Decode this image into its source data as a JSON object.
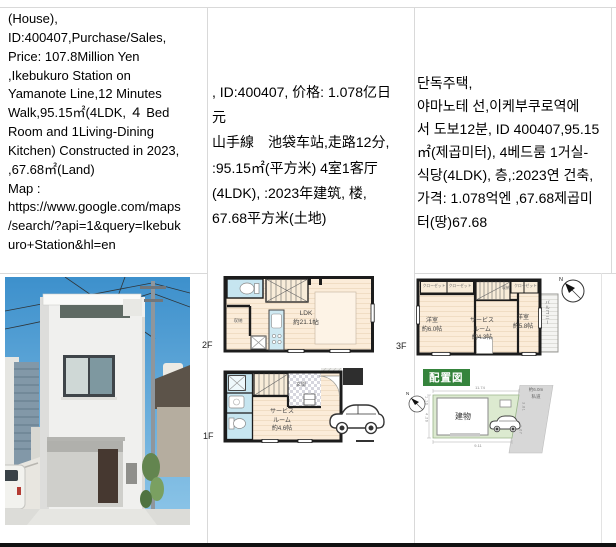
{
  "listing": {
    "en": "(House),\nID:400407,Purchase/Sales,\nPrice: 107.8Million Yen\n,Ikebukuro Station on\nYamanote Line,12 Minutes\nWalk,95.15㎡(4LDK, ４ Bed\nRoom and 1Living-Dining\nKitchen) Constructed in 2023,\n,67.68㎡(Land)\nMap :\nhttps://www.google.com/maps\n/search/?api=1&query=Ikebuk\nuro+Station&hl=en",
    "zh": ", ID:400407, 价格: 1.078亿日\n元\n山手線　池袋车站,走路12分,\n:95.15㎡(平方米) 4室1客厅\n(4LDK), :2023年建筑, 楼,\n67.68平方米(土地)",
    "ko": "단독주택,\n야마노테 선,이케부쿠로역에\n서 도보12분, ID 400407,95.15\n㎡(제곱미터), 4베드룸 1거실-\n식당(4LDK), 층,:2023연 건축,\n가격: 1.078억엔 ,67.68제곱미\n터(땅)67.68"
  },
  "plans": {
    "f2": {
      "floor_label": "2F",
      "ldk": "LDK\n約21.1帖",
      "closet": "収納"
    },
    "f3": {
      "floor_label": "3F",
      "room_left": "洋室\n約6.0帖",
      "room_mid": "サービス\nルーム\n約4.3帖",
      "room_right": "洋室\n約5.8帖",
      "balcony": "バルコニー",
      "closet_a": "クローゼット",
      "closet_b": "クローゼット",
      "closet_c": "クローゼット",
      "storage": "収納",
      "compass_n": "N"
    },
    "f1": {
      "floor_label": "1F",
      "service": "サービス\nルーム\n約4.6帖",
      "entrance": "玄関"
    },
    "site": {
      "title": "配置図",
      "building": "建物",
      "road": "約6.0m\n私道",
      "dim_top": "11.74",
      "dim_bottom": "9.11",
      "dim_left_top": "1.10",
      "dim_left_mid": "4.26",
      "dim_right_top": "3.81",
      "dim_right_bottom": "1.67",
      "compass_n": "N"
    }
  },
  "colors": {
    "table_border": "#d9d9d9",
    "bottom_bar": "#111111",
    "plan_wall": "#1c1c1c",
    "plan_floor": "#fbecd9",
    "fixture_blue": "#c6e5f0",
    "site_plot_green": "#dcead0",
    "site_road_gray": "#d7d7d7",
    "site_title_green": "#35843c",
    "photo_sky_blue": "#4498d4"
  }
}
